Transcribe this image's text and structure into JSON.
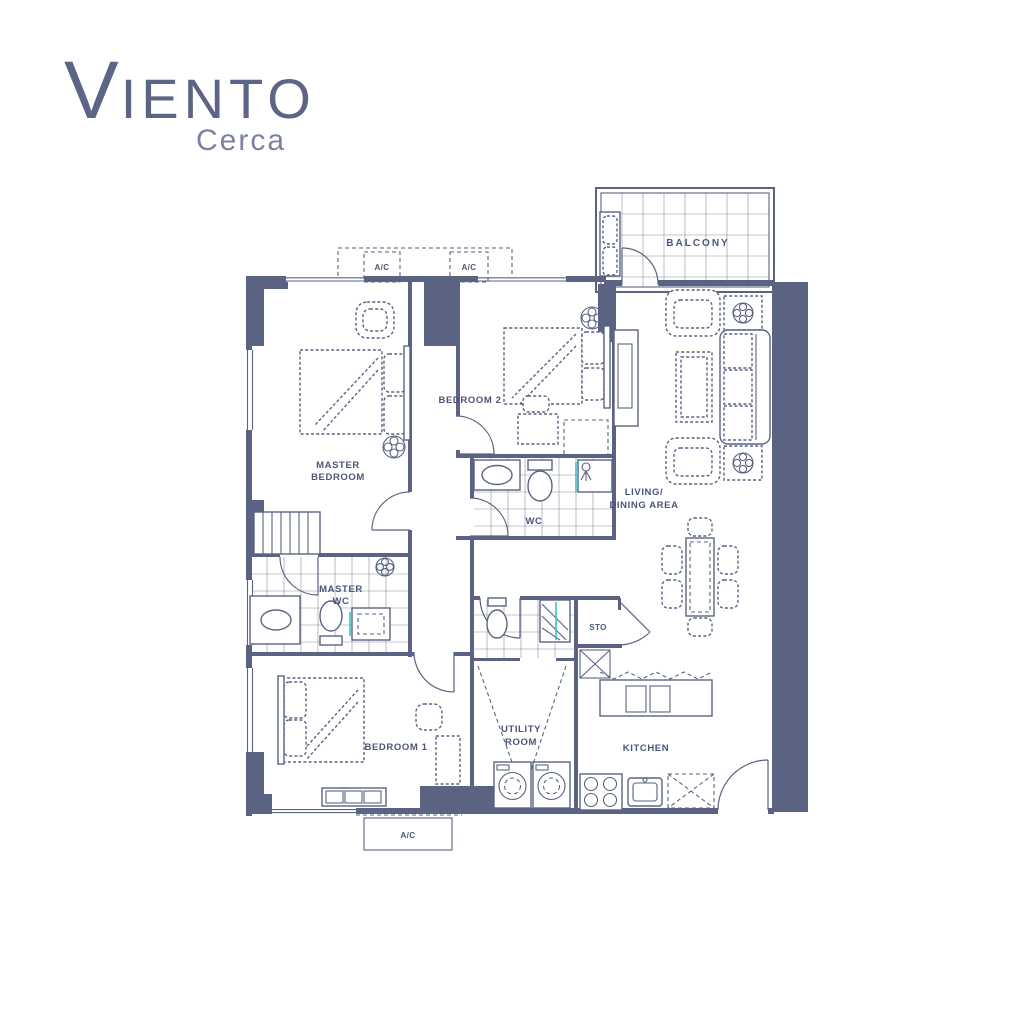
{
  "brand": {
    "initial": "V",
    "name_rest": "IENTO",
    "tagline": "Cerca"
  },
  "plan": {
    "rooms": {
      "balcony": "BALCONY",
      "master_bedroom_l1": "MASTER",
      "master_bedroom_l2": "BEDROOM",
      "bedroom2": "BEDROOM 2",
      "wc": "WC",
      "master_wc_l1": "MASTER",
      "master_wc_l2": "WC",
      "bedroom1": "BEDROOM 1",
      "utility_l1": "UTILITY",
      "utility_l2": "ROOM",
      "storage": "STO",
      "kitchen": "KITCHEN",
      "living_l1": "LIVING/",
      "living_l2": "DINING AREA"
    },
    "ac_units": [
      "A/C",
      "A/C",
      "A/C"
    ]
  },
  "colors": {
    "line": "#5a6382",
    "label_text": "#4a5578",
    "logo_primary": "#5d6586",
    "logo_secondary": "#7b82a2",
    "accent_teal": "#35c4c8",
    "background": "#ffffff"
  }
}
